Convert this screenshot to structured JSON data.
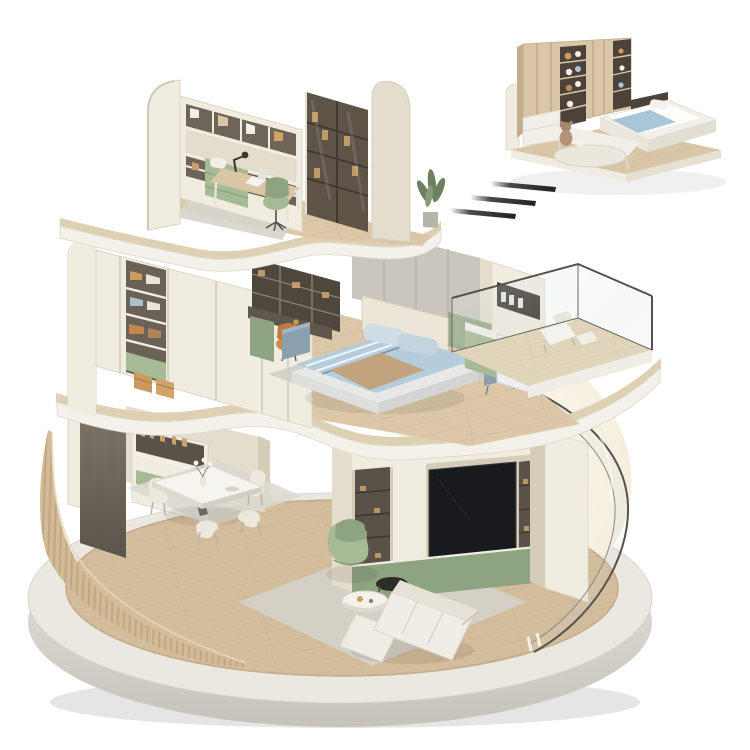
{
  "image_type": "isometric-3d-cutaway-home-render",
  "palette": {
    "bg": "#ffffff",
    "concrete_top": "#ebe8e2",
    "concrete_side": "#d7d4cd",
    "wood_floor": "#d4bd9d",
    "wood_floor_light": "#dcc8a8",
    "wood_slab": "#ded0b3",
    "slat_wall": "#d3ba97",
    "cream_light": "#f1ece0",
    "cream": "#e4ddcd",
    "cream_dark": "#d5cdba",
    "dark_wood": "#7a7265",
    "shelf_dark": "#5a5248",
    "gray_wall": "#cac6bd",
    "sage": "#a6ba95",
    "sage_dark": "#8ea37f",
    "blue_bedding": "#b5cddb",
    "blue_gray": "#8ba0ae",
    "throw_tan": "#c2a37d",
    "rug_gray": "#d4d1c9",
    "tv_black": "#191a1e",
    "glow": "#faf5e7",
    "white_soft": "#f4f1ea",
    "washer_white": "#edeff0",
    "glass_line": "#55524b",
    "arrow_dark": "#2b2927",
    "wood_inset": "#d8c6a6",
    "orange_chair": "#cd8a4b",
    "plant_green": "#6d8161",
    "headboard": "#ece6d8",
    "bed_base": "#e8e9e6"
  },
  "scene": {
    "base": {
      "label": "circular concrete display platform"
    },
    "floors": [
      {
        "name": "ground-floor",
        "rooms": [
          {
            "name": "dining-area",
            "items": [
              "curved-slat-wall",
              "dark-wood-panel",
              "sideboard-shelves",
              "dining-table",
              "dining-chairs",
              "vase-of-flowers",
              "dining-rug"
            ]
          },
          {
            "name": "living-room",
            "items": [
              "tv-wall-unit",
              "television",
              "display-niches",
              "green-base-cabinets",
              "lounge-armchair",
              "coffee-tables",
              "sofa",
              "living-rug",
              "curved-glass-facade"
            ]
          }
        ]
      },
      {
        "name": "middle-floor",
        "rooms": [
          {
            "name": "bedroom",
            "items": [
              "rounded-exterior-wall",
              "wardrobe-wall",
              "open-shelves-clothes",
              "wicker-baskets",
              "desk-with-shelving",
              "orange-chair",
              "gray-panel-wall",
              "green-accent-wall",
              "double-bed",
              "blue-bedding",
              "nightstands",
              "bedroom-rug"
            ]
          },
          {
            "name": "laundry-balcony",
            "items": [
              "laundry-cabinet",
              "washing-machine",
              "sink-counter",
              "balcony-floor",
              "balcony-glass-railing",
              "lounge-chair"
            ]
          }
        ]
      },
      {
        "name": "top-floor",
        "rooms": [
          {
            "name": "study",
            "items": [
              "rounded-exterior-walls",
              "bookshelf-wall",
              "glass-door-bookcase",
              "writing-desk",
              "laptop",
              "desk-lamp",
              "green-office-chair",
              "green-daybed",
              "study-rug",
              "potted-plant"
            ]
          }
        ]
      }
    ],
    "inset_module": {
      "name": "kids-bedroom-module",
      "items": [
        "wood-platform",
        "rounded-panel",
        "wood-wardrobe",
        "open-toy-shelves",
        "teddy-bear",
        "single-bed",
        "blue-blanket",
        "attached-desk",
        "round-rug"
      ]
    },
    "annotations": {
      "motion_dashes": 3
    }
  }
}
